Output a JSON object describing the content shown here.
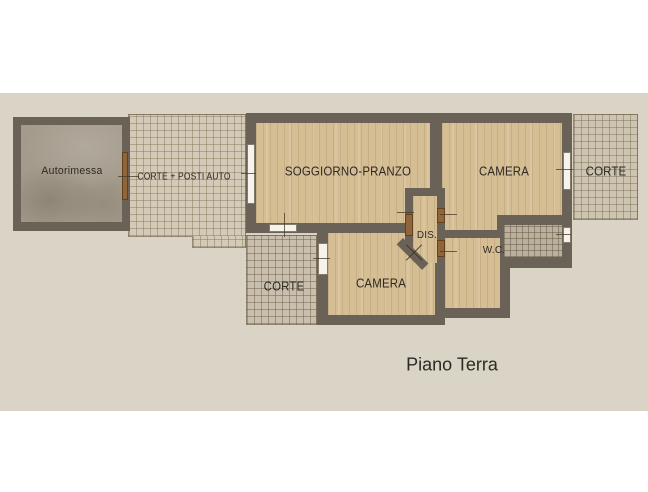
{
  "floor_plan": {
    "title": "Piano Terra",
    "rooms": {
      "autorimessa": {
        "label": "Autorimessa"
      },
      "corte_posti_auto": {
        "label": "CORTE + POSTI AUTO"
      },
      "soggiorno_pranzo": {
        "label": "SOGGIORNO-PRANZO"
      },
      "camera_top": {
        "label": "CAMERA"
      },
      "corte_right": {
        "label": "CORTE"
      },
      "dis": {
        "label": "DIS."
      },
      "wc": {
        "label": "W.C."
      },
      "camera_bottom": {
        "label": "CAMERA"
      },
      "corte_bottom": {
        "label": "CORTE"
      }
    },
    "colors": {
      "background": "#ffffff",
      "paper": "#d9d4c5",
      "wall": "#6a6256",
      "wood": "#d5bd94",
      "concrete": "#a49b8c",
      "tile_light": "#d3cab8",
      "tile_medium": "#c9bfae",
      "tile_right": "#cdc4b2",
      "tile_dark": "#bab09e",
      "door": "#91653a",
      "window": "#f6f3ec",
      "text": "#2d2924"
    }
  }
}
